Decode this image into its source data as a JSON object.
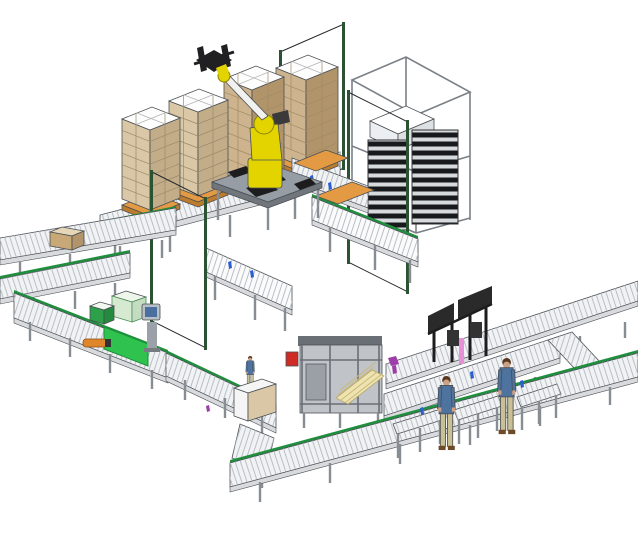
{
  "title": "Automated robotic palletizing cell and case packing conveyor line (3D CAD illustration)",
  "colors": {
    "background": "#ffffff",
    "outline": "#4a4f54",
    "deck": "#f1f2f4",
    "deck_side": "#d8dadd",
    "roller_line": "#b9bfc6",
    "leg_gray": "#878d93",
    "green_rail": "#1f8f3e",
    "belt_green": "#2fc24f",
    "belt_green_dark": "#1d8f38",
    "tote_green_dark": "#2da04a",
    "tote_green_darker": "#248a3d",
    "tote_green_light": "#d6ead2",
    "tote_green_light_side": "#c4ddc0",
    "carton_tan": "#d9c7a6",
    "carton_tan_side": "#c3ac88",
    "carton_brown": "#cdb48e",
    "carton_brown_side": "#b2946a",
    "box_top_white": "#fdfdfd",
    "pallet_orange": "#e39a42",
    "pallet_orange_dark": "#bd7c2c",
    "robot_yellow": "#e3d400",
    "robot_arm_white": "#f1f1ef",
    "gripper_black": "#202022",
    "table_gray": "#969da4",
    "table_side": "#70767c",
    "tooling_black": "#1d1d1f",
    "fence_mesh": "#26292d",
    "fence_post": "#2c5234",
    "dispenser_slat": "#d7dadd",
    "dispenser_dark": "#17191d",
    "frame_wire": "#7a8086",
    "machine_gray": "#c0c4c9",
    "machine_dark": "#6a6f75",
    "machine_red": "#cf2b25",
    "blank_cream": "#efe4b0",
    "accent_purple": "#9c3da8",
    "accent_pink": "#e690d8",
    "accent_blue": "#2b5fd0",
    "hmi_body": "#9aa1a9",
    "hmi_screen": "#49709f",
    "worker_shirt": "#4e739f",
    "worker_pants": "#c9c095",
    "worker_skin": "#cfa184",
    "worker_hair": "#59381f",
    "worker_shoes": "#6e4a28",
    "brown_box": "#c9a877",
    "brown_box_top": "#e5d6b8",
    "white_cube": "#eceff1",
    "white_cube_side": "#dde1e4",
    "cabinet_white": "#f5f5f5",
    "orange_tool": "#e0862a"
  },
  "scene": {
    "type": "3d-cad-render",
    "palletizing_cell": {
      "label": "Robotic palletizing cell",
      "robot": {
        "label": "palletizing robot with gripper",
        "joint_color_key": "robot_yellow",
        "arm_color_key": "robot_arm_white",
        "gripper_color_key": "gripper_black"
      },
      "box_stacks": [
        {
          "label": "palletized load 1",
          "carton": "tan",
          "top": "white",
          "pallet": "orange",
          "layers": 7
        },
        {
          "label": "palletized load 2",
          "carton": "tan",
          "top": "white",
          "pallet": "orange",
          "layers": 7
        },
        {
          "label": "palletized load 3",
          "carton": "brown",
          "top": "white",
          "pallet": "orange",
          "layers": 6
        },
        {
          "label": "palletized load 4",
          "carton": "brown",
          "top": "white",
          "pallet": "orange",
          "layers": 6
        }
      ],
      "pallet_dispenser": {
        "label": "empty pallet dispenser tower",
        "frame": "white wireframe",
        "slat_stacks": 2
      },
      "safety_fence": {
        "label": "dark mesh safety fence",
        "panel_count": 3
      },
      "pallet_conveyors": {
        "label": "pallet roller conveyors",
        "accents": [
          "green guide rail",
          "blue roller bands",
          "orange pallets"
        ]
      }
    },
    "packing_line": {
      "label": "Case packing conveyor line",
      "case_packer": {
        "label": "case packer with carton blank magazine",
        "accents": [
          "red lamp",
          "cream blanks",
          "purple part"
        ]
      },
      "inspection_gantry": {
        "label": "inspection gantry station",
        "accent": "pink strip"
      },
      "hmi_station": {
        "label": "operator HMI pedestal",
        "screen": "blue"
      },
      "belt_section": {
        "label": "green belt conveyor segment"
      },
      "items_on_line": [
        {
          "label": "carton on left conveyor",
          "color": "brown"
        },
        {
          "label": "small green tote"
        },
        {
          "label": "large light-green tote"
        },
        {
          "label": "purple part on outfeed"
        },
        {
          "label": "orange hand tool at line side"
        }
      ],
      "workers": {
        "count": 3,
        "shirt": "denim blue",
        "pants": "khaki"
      },
      "side_tables": {
        "count": 3,
        "label": "roller-top side tables"
      }
    }
  }
}
